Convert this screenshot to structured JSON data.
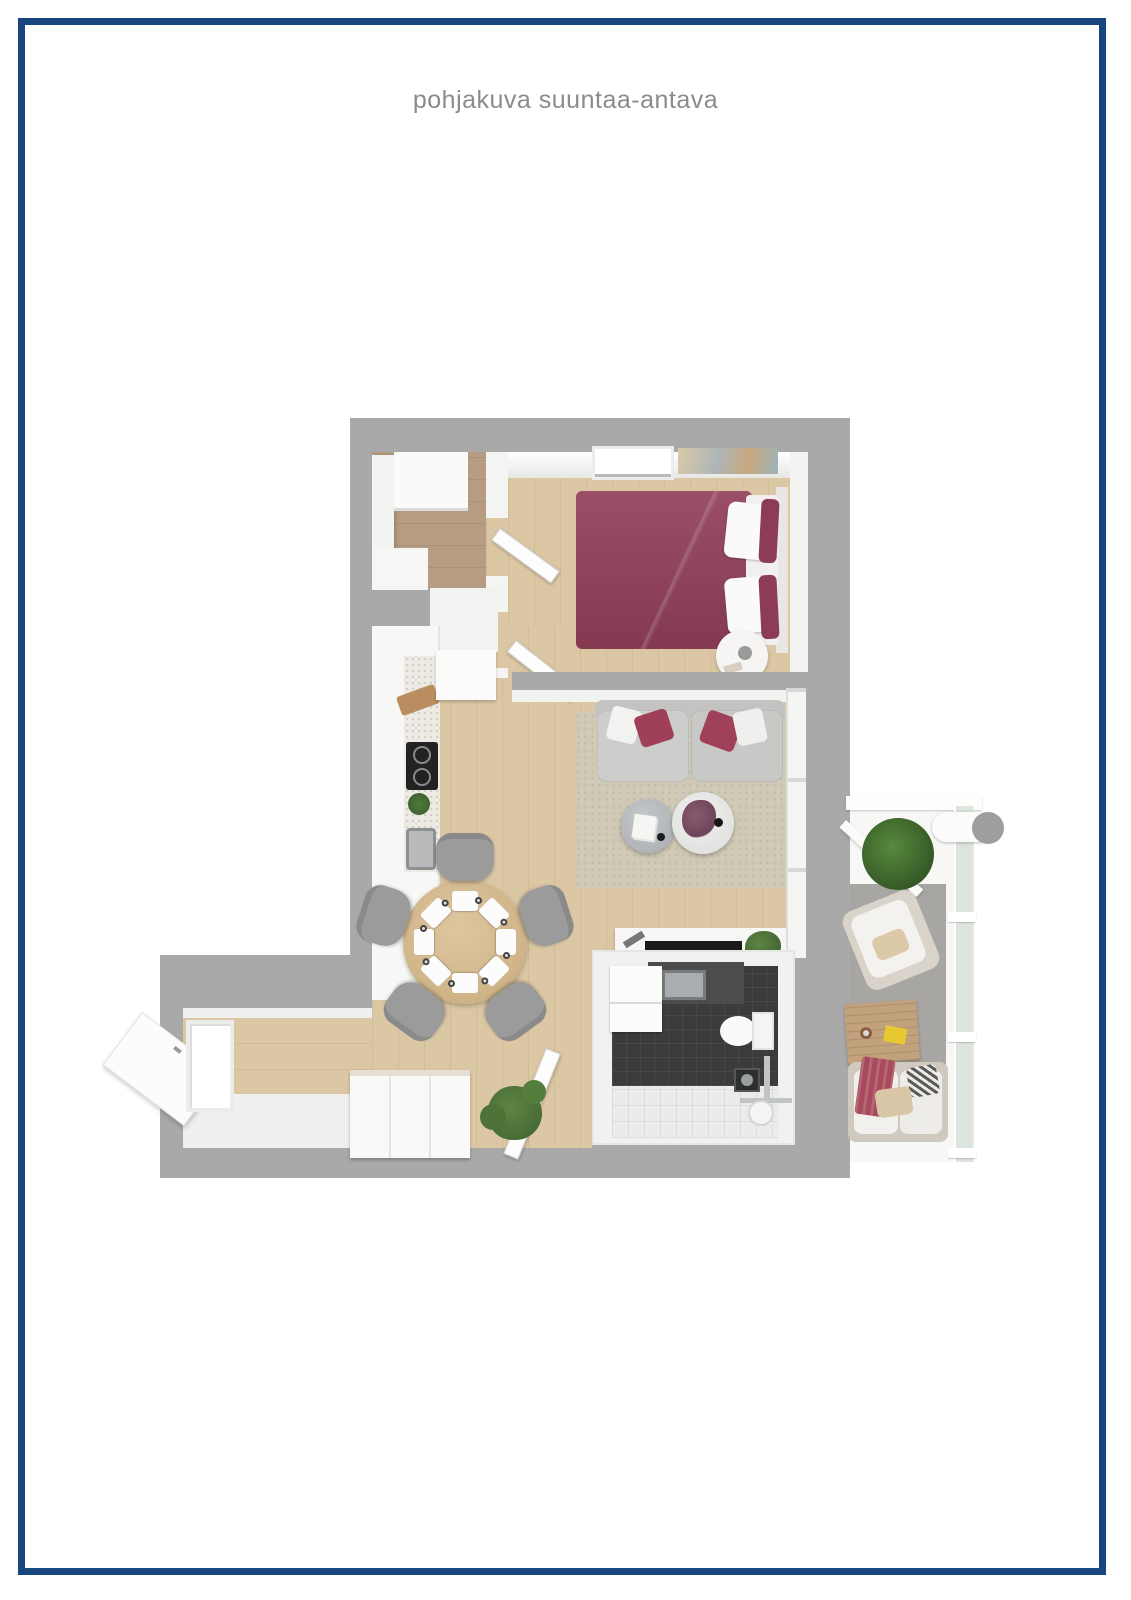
{
  "page": {
    "title": "pohjakuva suuntaa-antava",
    "background_color": "#ffffff",
    "frame_color": "#17477e",
    "title_color": "#8b8b8b"
  },
  "floor_plan": {
    "type": "3d-top-down-apartment-render",
    "wall_color": "#a9a9a9",
    "floor_wood_color": "#dcc7a4",
    "closet_floor_color": "#b59c82",
    "accent_bed_color": "#93405a",
    "bathroom_tile_color": "#3b3b3b",
    "balcony_glass_color": "#d6e2d8",
    "rooms": [
      {
        "name": "walk-in-closet",
        "features": [
          "white-cabinets",
          "dark-wood-floor"
        ]
      },
      {
        "name": "bedroom",
        "features": [
          "burgundy-double-bed",
          "white-pillows",
          "round-bedside-table",
          "window",
          "wall-art",
          "two-doors"
        ]
      },
      {
        "name": "kitchen",
        "features": [
          "cabinet-run",
          "speckled-countertop",
          "cooktop",
          "sink",
          "herb-plant",
          "cutting-board"
        ]
      },
      {
        "name": "dining-area",
        "features": [
          "round-wood-table",
          "five-gray-chairs",
          "eight-place-settings"
        ]
      },
      {
        "name": "living-room",
        "features": [
          "gray-sofa",
          "red-and-white-cushions",
          "area-rug",
          "gray-round-coffee-table",
          "white-round-coffee-table",
          "flower-arrangement",
          "tv-bench",
          "tv",
          "window-wall"
        ]
      },
      {
        "name": "bathroom",
        "features": [
          "dark-tile-floor",
          "white-tile-shower-zone",
          "washing-machine",
          "vanity-sink",
          "toilet",
          "floor-drain",
          "shower-fixture",
          "open-door"
        ]
      },
      {
        "name": "entry-hall",
        "features": [
          "white-sideboard",
          "floor-plant",
          "open-entry-door",
          "window",
          "white-entry-floor"
        ]
      },
      {
        "name": "balcony",
        "features": [
          "glass-railing",
          "white-outdoor-sofa",
          "red-blanket",
          "striped-pillow",
          "lounge-armchair",
          "wood-coffee-table",
          "yellow-book",
          "bush-plant",
          "gray-rug",
          "pipe-detail"
        ]
      }
    ]
  }
}
